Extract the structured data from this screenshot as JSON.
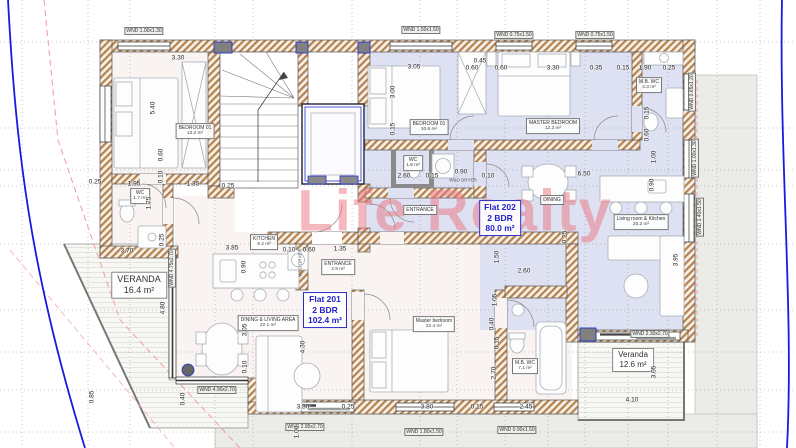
{
  "watermark": {
    "text": "Life Realty"
  },
  "colors": {
    "flat201_floor": "#f9f4f2",
    "flat202_floor": "#dde1f2",
    "wall_hatch": "#b5824f",
    "boundary_blue": "#1a1adf",
    "setback_pink": "#f0a3ab",
    "flat_label_blue": "#2222cc",
    "watermark_pink": "#e97682"
  },
  "flats": [
    {
      "name": "Flat 201",
      "bedrooms": "2 BDR",
      "area": "102.4 m²"
    },
    {
      "name": "Flat 202",
      "bedrooms": "2 BDR",
      "area": "80.0 m²"
    }
  ],
  "verandas": [
    {
      "name": "VERANDA",
      "area": "16.4 m²"
    },
    {
      "name": "Veranda",
      "area": "12.6 m²"
    }
  ],
  "rooms": [
    {
      "label": "BEDROOM 01",
      "area": "13.2 m²"
    },
    {
      "label": "WC",
      "area": "1.7 m²"
    },
    {
      "label": "KITCHEN",
      "area": "9.2 m²"
    },
    {
      "label": "DINING & LIVING AREA",
      "area": "22.1 m²"
    },
    {
      "label": "ENTRANCE",
      "area": "2.9 m²"
    },
    {
      "label": "Master bedroom",
      "area": "22.4 m²"
    },
    {
      "label": "M.B. WC",
      "area": "7.1 m²"
    },
    {
      "label": "BEDROOM 01",
      "area": "10.6 m²"
    },
    {
      "label": "MASTER BEDROOM",
      "area": "12.3 m²"
    },
    {
      "label": "M.B. WC",
      "area": "4.3 m²"
    },
    {
      "label": "WC",
      "area": "1.6 m²"
    },
    {
      "label": "ENTRANCE",
      "area": ""
    },
    {
      "label": "Living room & Kitchen",
      "area": "20.2 m²"
    },
    {
      "label": "DINING",
      "area": ""
    }
  ],
  "windows": [
    "WND 1.00x1.30",
    "WND 1.50x1.50",
    "WND 0.75x1.50",
    "WND 0.75x1.50",
    "WND 0.65x1.20",
    "WND 1.00x1.30",
    "WND 1.40x1.50",
    "WND 4.75x2.70",
    "WND 4.90x2.70",
    "WND 2.95x2.70",
    "WND 1.80x1.50",
    "WND 0.90x1.50",
    "WND 2.30x2.70"
  ],
  "appliances": [
    "W&D DRYER",
    "W&D DRYER"
  ],
  "dims": [
    "3.30",
    "5.40",
    "0.60",
    "0.10",
    "0.25",
    "1.95",
    "1.35",
    "0.25",
    "1.75",
    "0.25",
    "3.70",
    "4.80",
    "0.85",
    "3.85",
    "0.90",
    "0.10",
    "0.60",
    "1.35",
    "3.05",
    "0.10",
    "0.40",
    "4.30",
    "3.30",
    "0.25",
    "3.80",
    "0.15",
    "2.45",
    "1.00",
    "1.05",
    "0.40",
    "0.15",
    "2.70",
    "3.05",
    "0.45",
    "0.60",
    "0.60",
    "3.30",
    "0.35",
    "0.15",
    "1.90",
    "0.25",
    "3.00",
    "0.15",
    "2.60",
    "0.15",
    "0.90",
    "0.10",
    "6.50",
    "1.50",
    "2.60",
    "1.00",
    "0.90",
    "0.15",
    "0.60",
    "3.95",
    "3.05",
    "4.10",
    "0.25"
  ]
}
